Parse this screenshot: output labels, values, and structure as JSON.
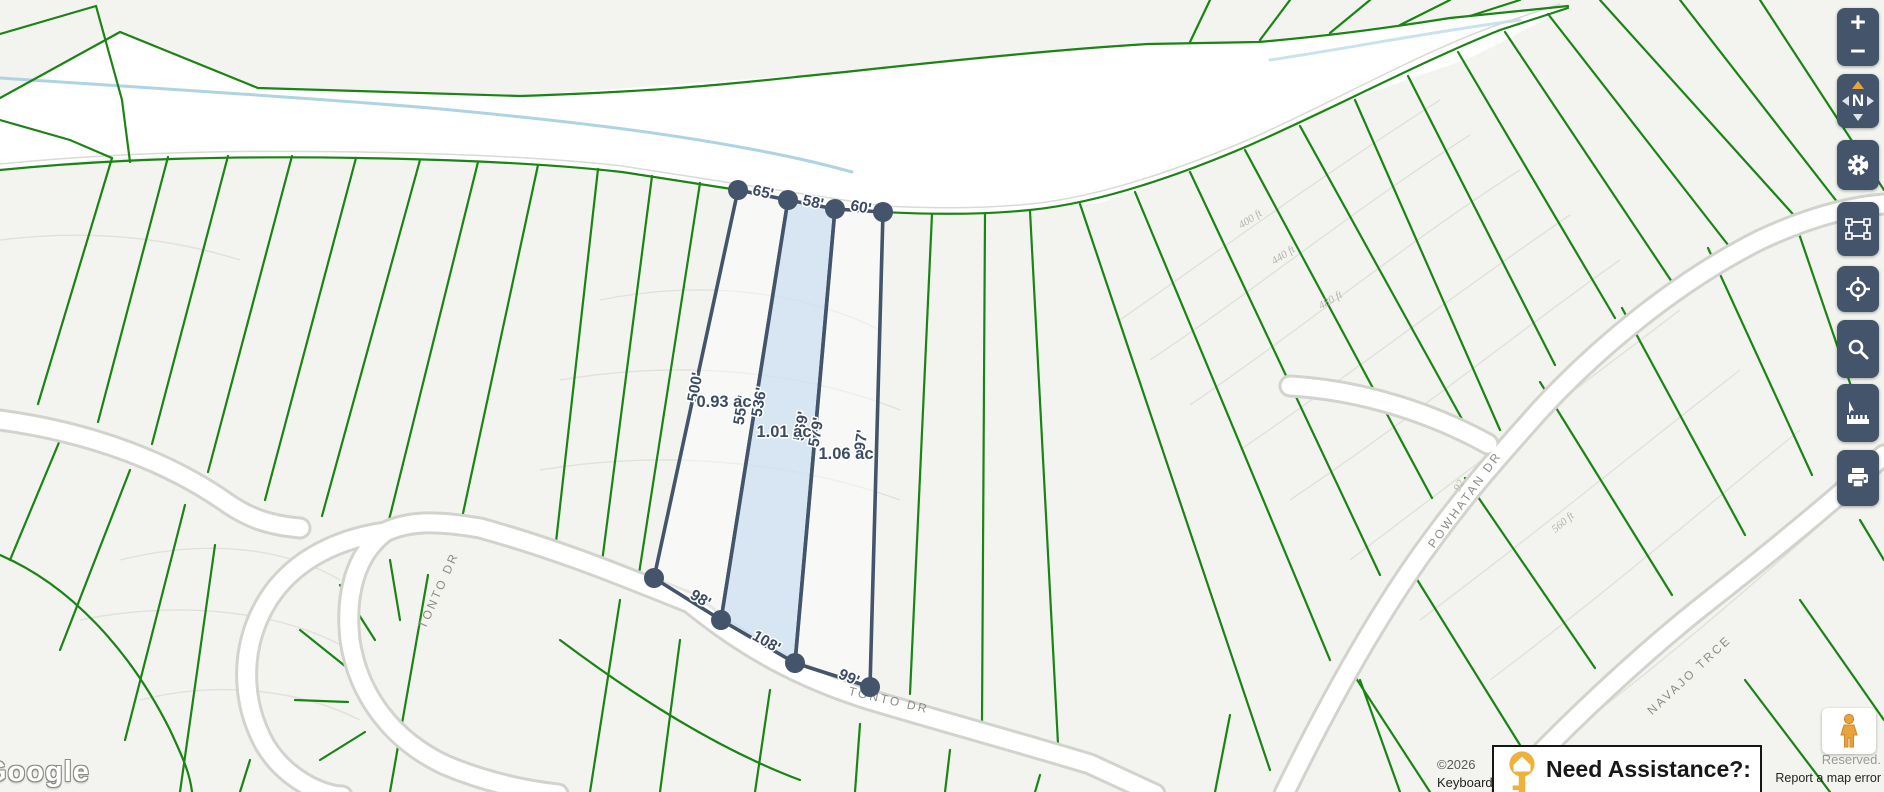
{
  "map": {
    "selected_parcels": {
      "areas": [
        "0.93 ac",
        "1.01 ac",
        "1.06 ac"
      ],
      "top_widths": [
        "65'",
        "58'",
        "60'"
      ],
      "side_lengths": [
        "500'",
        "556'",
        "536'",
        "569'",
        "579'",
        "97'"
      ],
      "bottom_widths": [
        "98'",
        "108'",
        "99'"
      ]
    },
    "streets": [
      {
        "name": "TONTO DR"
      },
      {
        "name": "TONTO DR"
      },
      {
        "name": "POWHATAN DR"
      },
      {
        "name": "NAVAJO TRCE"
      }
    ],
    "contour_labels": [
      "400 ft",
      "440 ft",
      "480 ft",
      "560 ft",
      "92"
    ]
  },
  "controls": {
    "zoom_in": "+",
    "zoom_out": "−",
    "compass": "N",
    "toolbar_icons": [
      "settings-gear",
      "marquee-select",
      "locate-crosshair",
      "search",
      "measure-ruler",
      "print"
    ]
  },
  "assistance_banner": {
    "label": "Need Assistance?:",
    "icon": "gold-key"
  },
  "attribution": {
    "watermark": "Google",
    "copyright": "©2026",
    "keyboard": "Keyboard shortcuts",
    "rights": "Reserved.",
    "report_link": "Report a map error"
  },
  "colors": {
    "control_slate": "#44546A",
    "parcel_line_green": "#1a8414",
    "selection_outline": "#44546A",
    "selection_fill": "#cfe2f3",
    "key_gold": "#E8A33D",
    "road_fill": "#ffffff",
    "creek_blue": "#aed3e3"
  }
}
